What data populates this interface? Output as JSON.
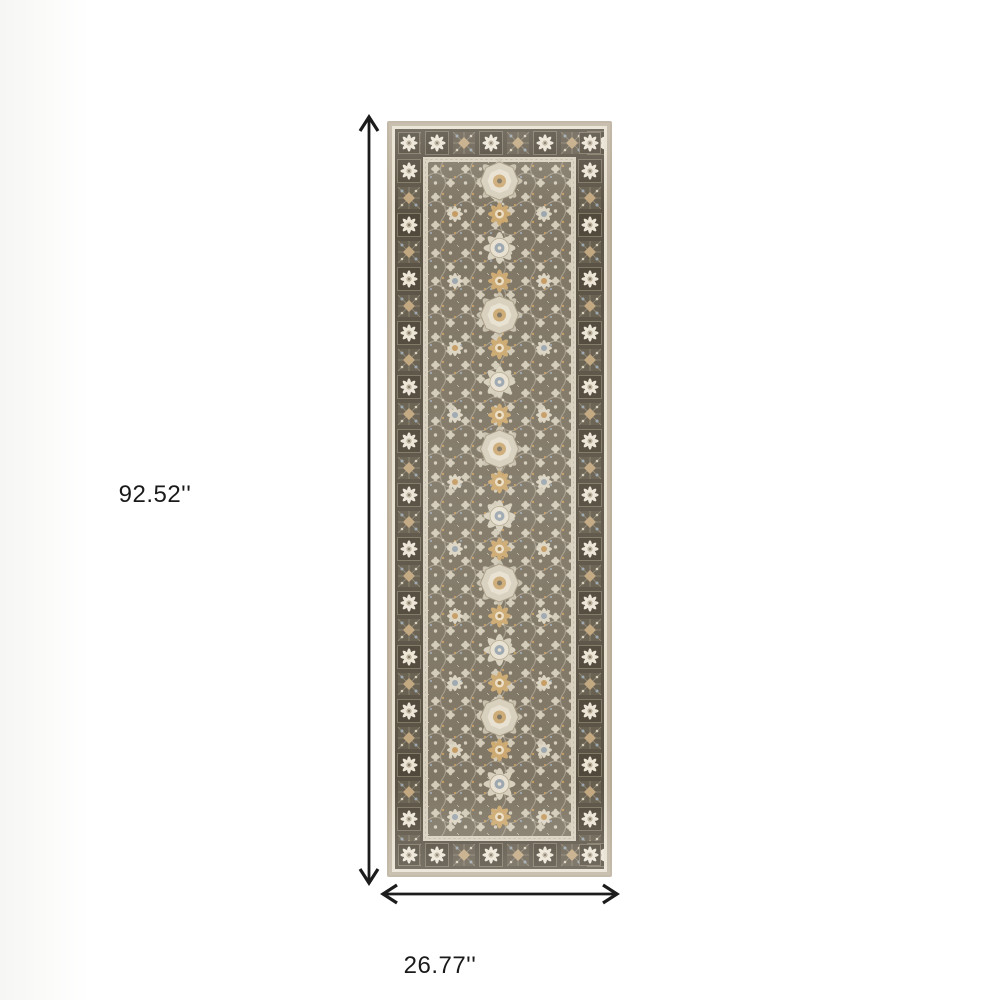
{
  "figure": {
    "type": "product-dimension-image",
    "subject": "Gray and ivory oriental style runner rug with floral medallion pattern",
    "background_color": "#ffffff"
  },
  "dimensions": {
    "unit": "inches",
    "height": {
      "label": "92.52''",
      "value": 92.52
    },
    "width": {
      "label": "26.77''",
      "value": 26.77
    }
  },
  "annotation_style": {
    "arrow_color": "#1c1c1c",
    "label_color": "#1a1a1a"
  },
  "rug_palette": {
    "edge": "#b7aa96",
    "ivory_frame": "#e7e0d0",
    "border_dark": "#5a5244",
    "border_square_dark": "#50483a",
    "field": "#7f7665",
    "ornament_cream": "#d8d0bd",
    "ornament_ivory": "#e8e1d1",
    "accent_gold": "#c59c63",
    "accent_blue": "#9ca7b0",
    "accent_tan": "#c2a77f"
  }
}
